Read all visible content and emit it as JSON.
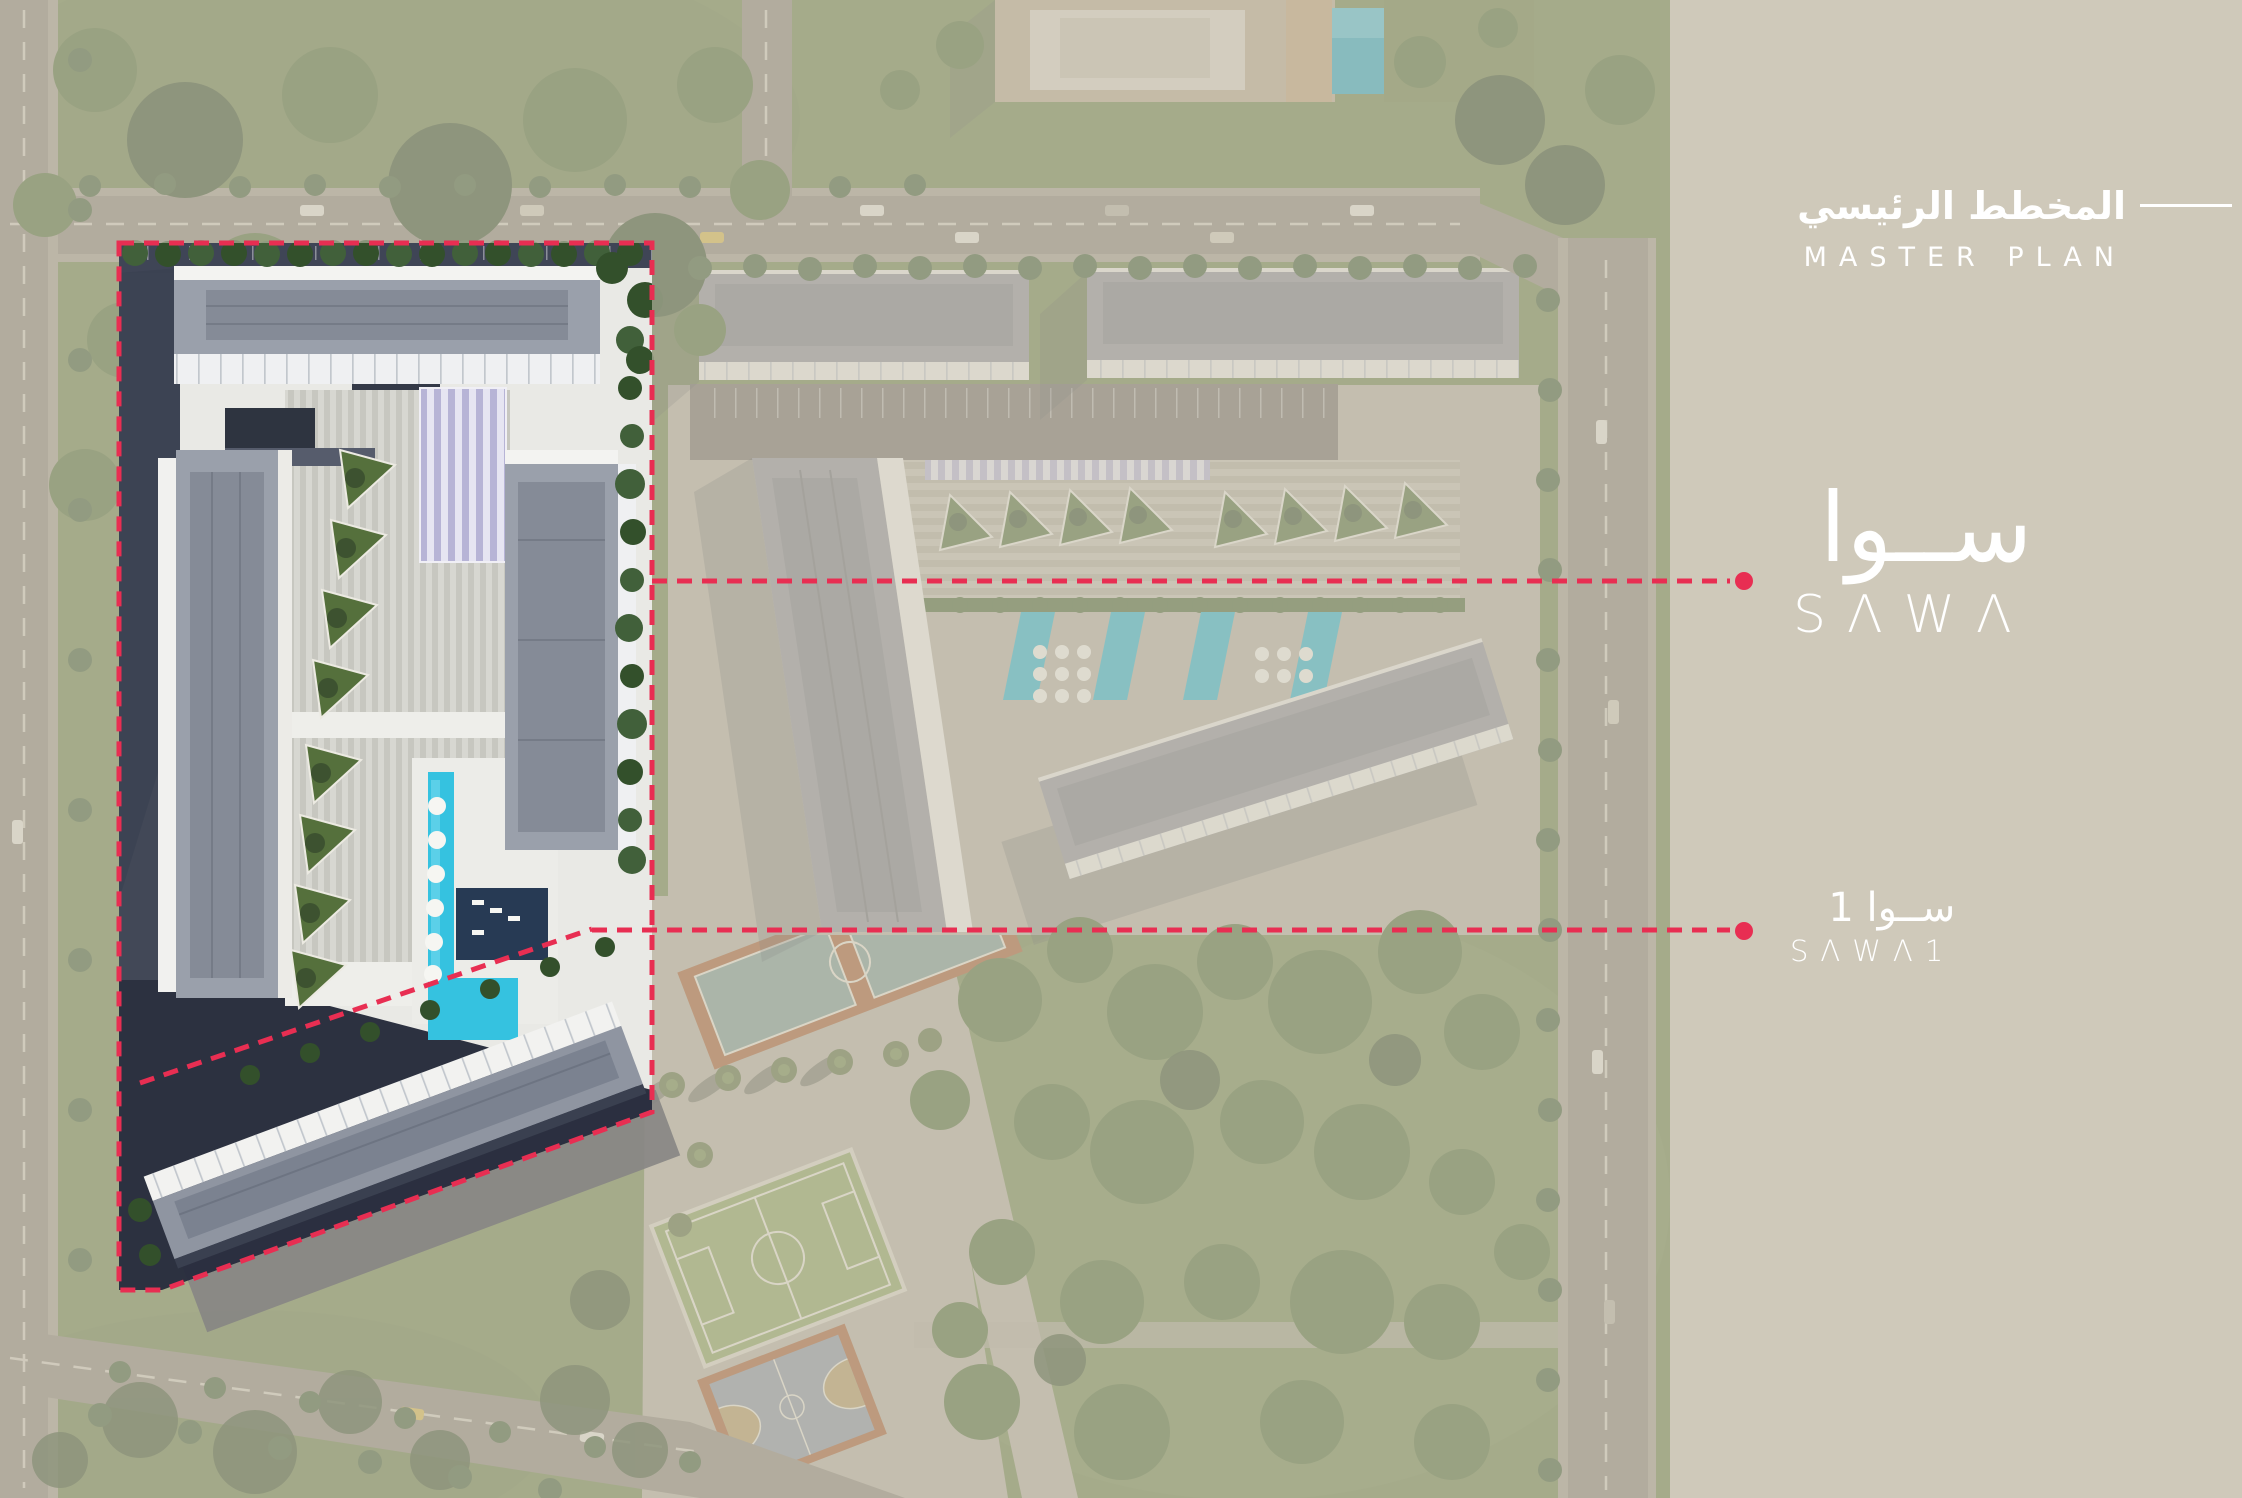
{
  "colors": {
    "accent_red": "#e82e52",
    "panel_beige": "#cfc9ba",
    "text_white": "#ffffff",
    "pool_cyan": "#35c2e0",
    "grass_green": "#71854f",
    "roof_gray": "#9aa0ab"
  },
  "panel": {
    "title_ar": "المخطط الرئيسي",
    "title_en": "MASTER PLAN"
  },
  "logo": {
    "ar": "ســوا",
    "en": "SΛWΛ"
  },
  "plot_label": {
    "ar": "ســوا 1",
    "en": "SΛWΛ1"
  },
  "icons": {
    "leader_dot": "filled-circle",
    "leader_line": "red-dashed-line",
    "plot_boundary": "red-dashed-polygon",
    "title_rule": "white-horizontal-rule"
  }
}
